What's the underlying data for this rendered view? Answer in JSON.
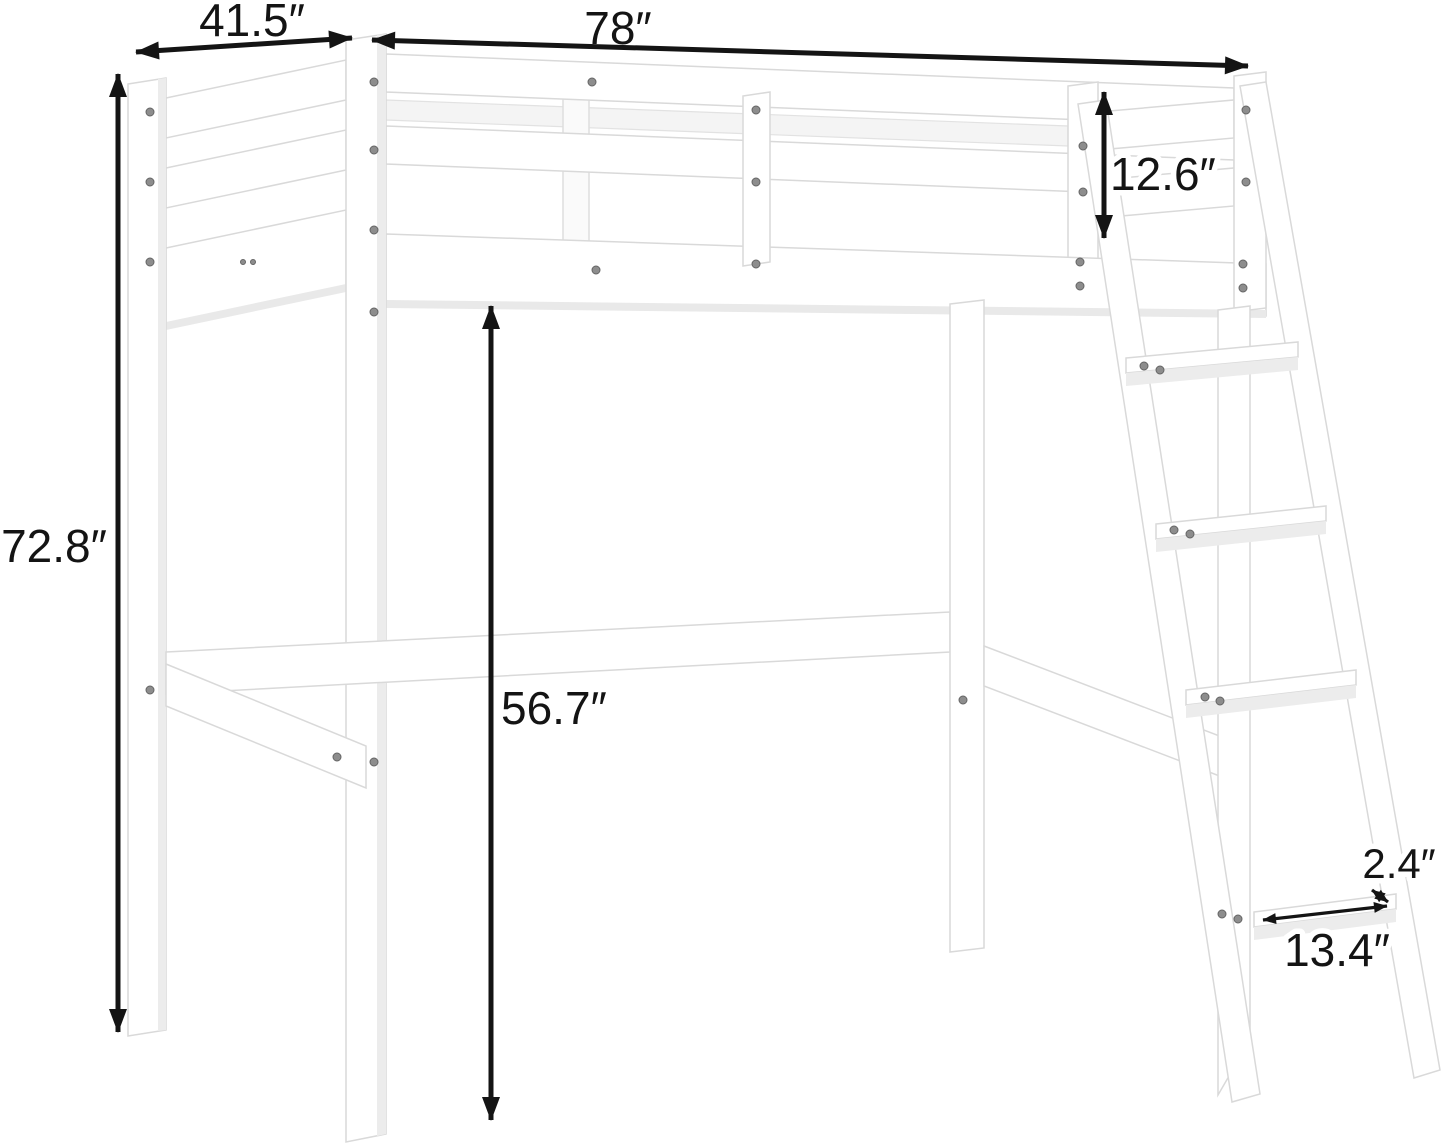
{
  "page": {
    "title": "Loft bed dimension diagram",
    "background": "#ffffff"
  },
  "diagram": {
    "type": "product-dimension-diagram",
    "subject": "Twin wooden loft bed with guardrails, angled ladder and support rails",
    "unit": "inches",
    "bed_color": "#ffffff",
    "edge_color": "#d9d9d9",
    "dimension_color": "#141414",
    "dimensions": {
      "depth": "41.5″",
      "length": "78″",
      "guardrail_height": "12.6″",
      "overall_height": "72.8″",
      "clearance_height": "56.7″",
      "step_thickness": "2.4″",
      "step_width": "13.4″"
    }
  }
}
